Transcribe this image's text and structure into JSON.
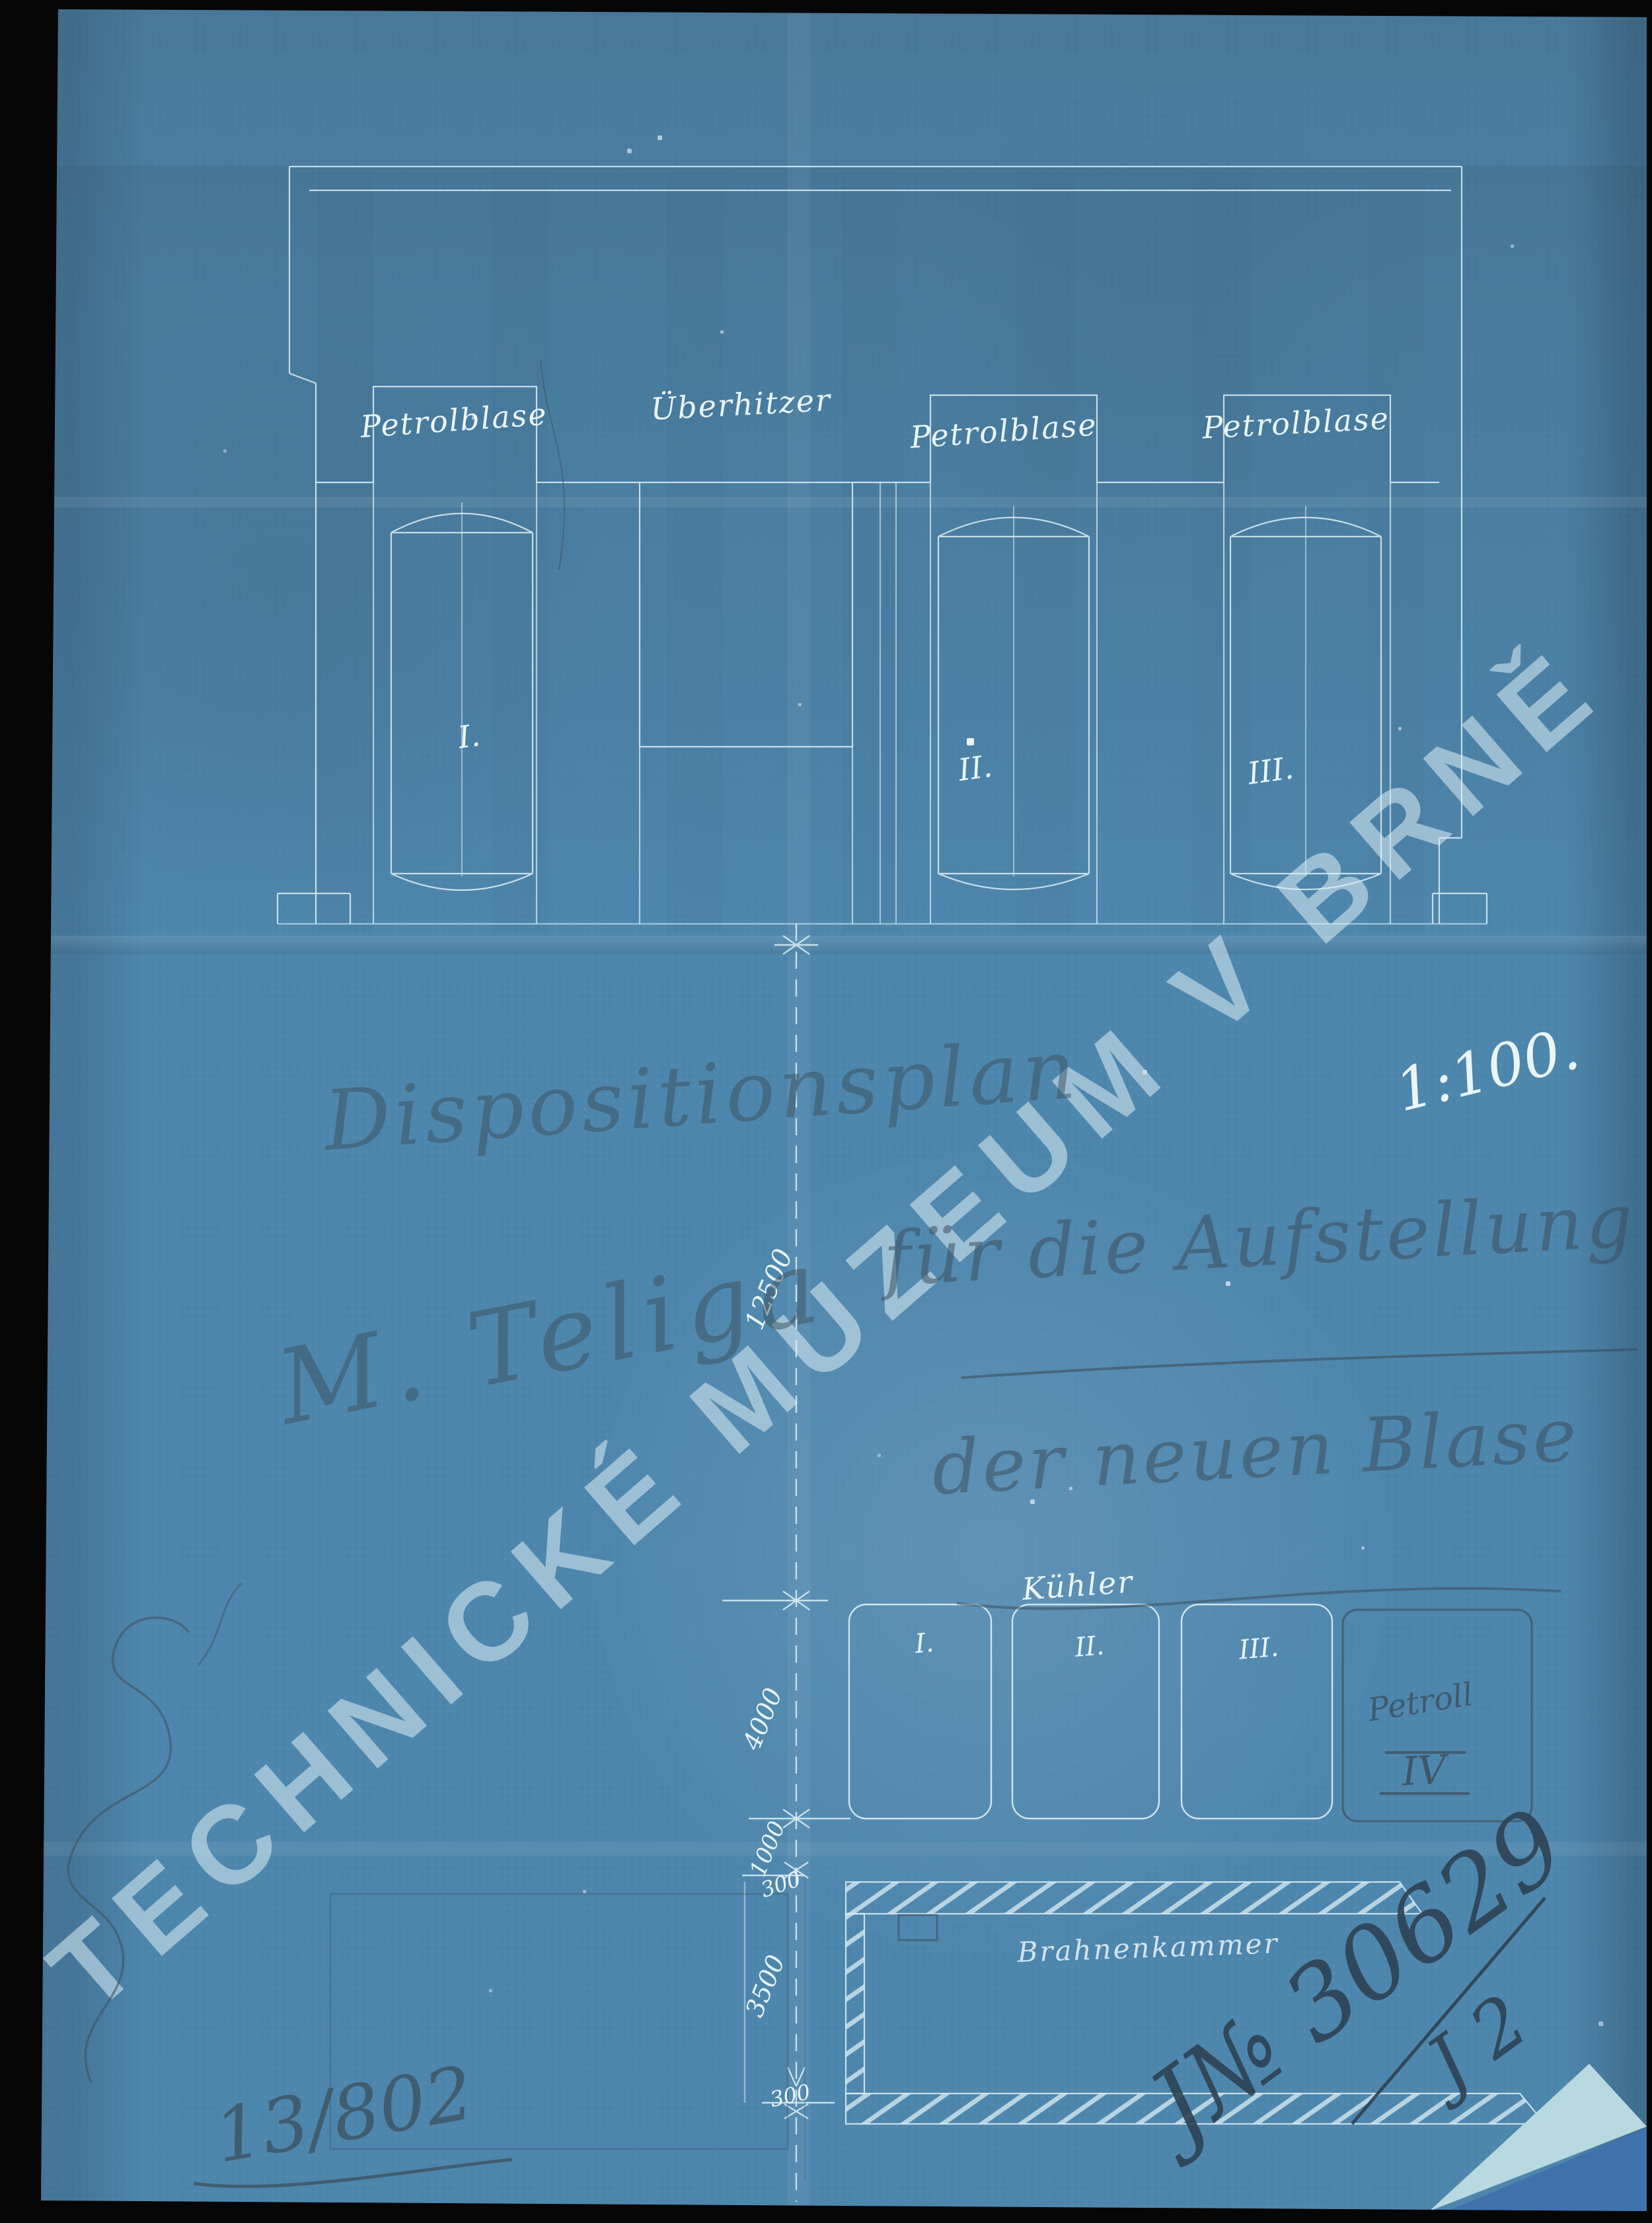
{
  "watermark": {
    "text": "TECHNICKÉ MUZEUM V BRNĚ"
  },
  "document": {
    "scale": "1:100.",
    "title": "Dispositionsplan",
    "subtitle_line1": "für die Aufstellung",
    "subtitle_line2": "der neuen Blase",
    "signature": "M. Teliga",
    "file_number": "13/802",
    "registry_number": "J№ 30629",
    "registry_suffix": "J 2"
  },
  "plan": {
    "compartments": [
      {
        "label": "Petrolblase",
        "unit": "I."
      },
      {
        "label": "Überhitzer",
        "unit": ""
      },
      {
        "label": "Petrolblase",
        "unit": "II."
      },
      {
        "label": "Petrolblase",
        "unit": "III."
      }
    ],
    "cooler": {
      "label": "Kühler",
      "units": [
        "I.",
        "II.",
        "III."
      ],
      "pencil_unit_label": "Petroll",
      "pencil_unit_numeral": "IV"
    },
    "chamber_label": "Brahnenkammer",
    "dimensions": {
      "total_height": "12500",
      "cooler_depth": "4000",
      "gap": "1000",
      "wall_top": "300",
      "chamber_depth": "3500",
      "wall_bottom": "300"
    }
  },
  "colors": {
    "paper": "#4d86ad",
    "line": "#dceef3",
    "pencil": "#3c4f5c",
    "ink": "#2e4152",
    "fold_light": "#b9d9e0",
    "fold_dark": "#3f72ad",
    "background": "#060606"
  }
}
